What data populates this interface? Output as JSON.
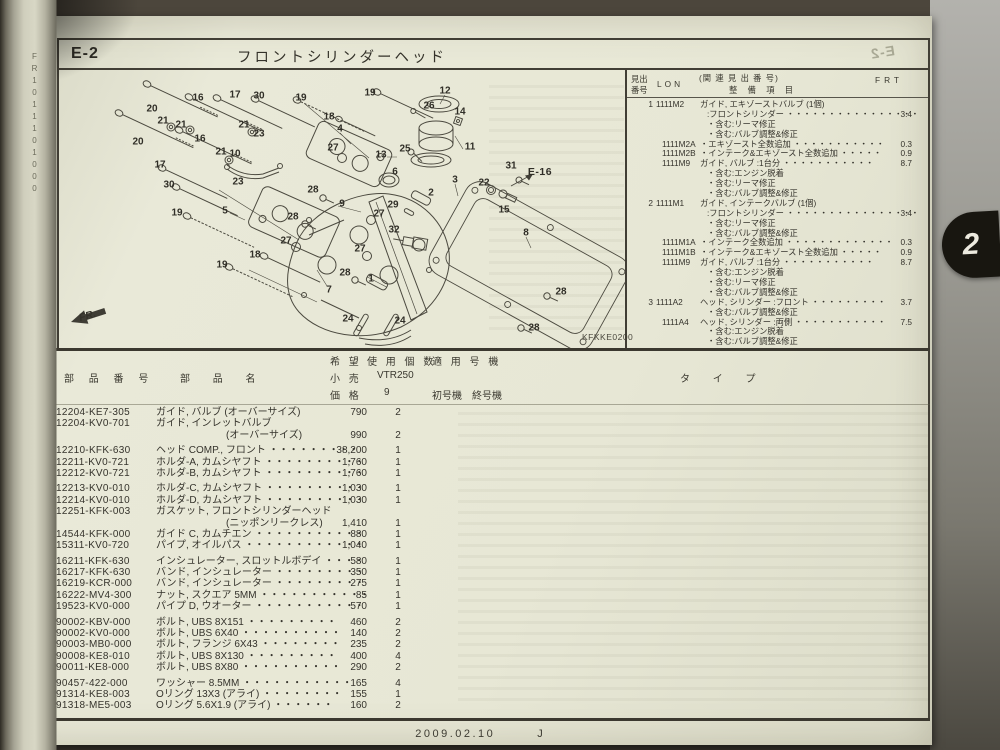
{
  "colors": {
    "page_bg": "#e8e8d7",
    "ink": "#35332c",
    "frame_line": "#413e35",
    "tab_bg": "#181610",
    "tab_text": "#eceadf",
    "desk": "#45403a"
  },
  "spine": {
    "label": "FR",
    "digits": "1011101000"
  },
  "page": {
    "section_code": "E-2",
    "title": "フロントシリンダーヘッド",
    "footer_date": "2009.02.10",
    "footer_mark": "J",
    "tab_number": "2",
    "mirrored_code": "E-2"
  },
  "diagram": {
    "code": "KFKKE0200",
    "fr_label": "FR.",
    "callouts": [
      {
        "t": "20",
        "x": 93,
        "y": 39
      },
      {
        "t": "16",
        "x": 139,
        "y": 28
      },
      {
        "t": "17",
        "x": 176,
        "y": 25
      },
      {
        "t": "30",
        "x": 200,
        "y": 26
      },
      {
        "t": "19",
        "x": 242,
        "y": 28
      },
      {
        "t": "19",
        "x": 311,
        "y": 23
      },
      {
        "t": "18",
        "x": 270,
        "y": 47
      },
      {
        "t": "4",
        "x": 281,
        "y": 59
      },
      {
        "t": "21",
        "x": 104,
        "y": 51
      },
      {
        "t": "21",
        "x": 122,
        "y": 55
      },
      {
        "t": "21",
        "x": 185,
        "y": 55
      },
      {
        "t": "23",
        "x": 200,
        "y": 64
      },
      {
        "t": "20",
        "x": 79,
        "y": 72
      },
      {
        "t": "16",
        "x": 141,
        "y": 69
      },
      {
        "t": "21",
        "x": 162,
        "y": 82
      },
      {
        "t": "10",
        "x": 176,
        "y": 84
      },
      {
        "t": "27",
        "x": 274,
        "y": 78
      },
      {
        "t": "17",
        "x": 101,
        "y": 95
      },
      {
        "t": "23",
        "x": 179,
        "y": 112
      },
      {
        "t": "28",
        "x": 254,
        "y": 120
      },
      {
        "t": "30",
        "x": 110,
        "y": 115
      },
      {
        "t": "19",
        "x": 118,
        "y": 143
      },
      {
        "t": "5",
        "x": 166,
        "y": 141
      },
      {
        "t": "28",
        "x": 234,
        "y": 147
      },
      {
        "t": "9",
        "x": 283,
        "y": 134
      },
      {
        "t": "27",
        "x": 227,
        "y": 171
      },
      {
        "t": "18",
        "x": 196,
        "y": 185
      },
      {
        "t": "19",
        "x": 163,
        "y": 195
      },
      {
        "t": "7",
        "x": 270,
        "y": 220
      },
      {
        "t": "24",
        "x": 289,
        "y": 249
      },
      {
        "t": "24",
        "x": 341,
        "y": 251
      },
      {
        "t": "12",
        "x": 386,
        "y": 21
      },
      {
        "t": "26",
        "x": 370,
        "y": 36
      },
      {
        "t": "14",
        "x": 401,
        "y": 42
      },
      {
        "t": "13",
        "x": 322,
        "y": 85
      },
      {
        "t": "25",
        "x": 346,
        "y": 79
      },
      {
        "t": "11",
        "x": 411,
        "y": 77
      },
      {
        "t": "6",
        "x": 336,
        "y": 102
      },
      {
        "t": "3",
        "x": 396,
        "y": 110
      },
      {
        "t": "22",
        "x": 425,
        "y": 113
      },
      {
        "t": "31",
        "x": 452,
        "y": 96
      },
      {
        "t": "E-16",
        "x": 481,
        "y": 102,
        "b": 1
      },
      {
        "t": "2",
        "x": 372,
        "y": 123
      },
      {
        "t": "29",
        "x": 334,
        "y": 135
      },
      {
        "t": "27",
        "x": 320,
        "y": 144
      },
      {
        "t": "15",
        "x": 445,
        "y": 140
      },
      {
        "t": "32",
        "x": 335,
        "y": 160
      },
      {
        "t": "27",
        "x": 301,
        "y": 179
      },
      {
        "t": "28",
        "x": 286,
        "y": 203
      },
      {
        "t": "1",
        "x": 312,
        "y": 209
      },
      {
        "t": "8",
        "x": 467,
        "y": 163
      },
      {
        "t": "28",
        "x": 502,
        "y": 222
      },
      {
        "t": "28",
        "x": 475,
        "y": 258
      }
    ]
  },
  "service_table": {
    "header": {
      "no1": "見出",
      "no2": "番号",
      "lon": "LON",
      "rel": "(関 連 見 出 番 号)",
      "item": "整 備 項 目",
      "frt": "FRT"
    },
    "rows": [
      {
        "n": "1",
        "l": "1111M2",
        "t": "ガイド, エキゾーストバルブ (1個)"
      },
      {
        "t": ":フロントシリンダー ・・・・・・・・・・・・・・・・",
        "f": "3.4",
        "i": 1
      },
      {
        "t": "・含む:リーマ修正",
        "i": 1
      },
      {
        "t": "・含む:バルブ調整&修正",
        "i": 1
      },
      {
        "l": "1111M2A",
        "t": "・エキゾースト全数追加 ・・・・・・・・・・・",
        "f": "0.3",
        "s": 1
      },
      {
        "l": "1111M2B",
        "t": "・インテーク&エキゾースト全数追加 ・・・・・",
        "f": "0.9",
        "s": 1
      },
      {
        "l": "1111M9",
        "t": "ガイド, バルブ :1台分 ・・・・・・・・・・・",
        "f": "8.7",
        "s": 1
      },
      {
        "t": "・含む:エンジン脱着",
        "i": 1
      },
      {
        "t": "・含む:リーマ修正",
        "i": 1
      },
      {
        "t": "・含む:バルブ調整&修正",
        "i": 1
      },
      {
        "n": "2",
        "l": "1111M1",
        "t": "ガイド, インテークバルブ (1個)"
      },
      {
        "t": ":フロントシリンダー ・・・・・・・・・・・・・・・・",
        "f": "3.4",
        "i": 1
      },
      {
        "t": "・含む:リーマ修正",
        "i": 1
      },
      {
        "t": "・含む:バルブ調整&修正",
        "i": 1
      },
      {
        "l": "1111M1A",
        "t": "・インテーク全数追加 ・・・・・・・・・・・・・",
        "f": "0.3",
        "s": 1
      },
      {
        "l": "1111M1B",
        "t": "・インテーク&エキゾースト全数追加 ・・・・・",
        "f": "0.9",
        "s": 1
      },
      {
        "l": "1111M9",
        "t": "ガイド, バルブ :1台分 ・・・・・・・・・・・",
        "f": "8.7",
        "s": 1
      },
      {
        "t": "・含む:エンジン脱着",
        "i": 1
      },
      {
        "t": "・含む:リーマ修正",
        "i": 1
      },
      {
        "t": "・含む:バルブ調整&修正",
        "i": 1
      },
      {
        "n": "3",
        "l": "1111A2",
        "t": "ヘッド, シリンダー :フロント ・・・・・・・・・",
        "f": "3.7"
      },
      {
        "t": "・含む:バルブ調整&修正",
        "i": 1
      },
      {
        "l": "1111A4",
        "t": "ヘッド, シリンダー :両側 ・・・・・・・・・・・",
        "f": "7.5",
        "s": 1
      },
      {
        "t": "・含む:エンジン脱着",
        "i": 1
      },
      {
        "t": "・含む:バルブ調整&修正",
        "i": 1
      }
    ]
  },
  "parts_table": {
    "header": {
      "no1": "見出",
      "no2": "番号",
      "part": "部 品 番 号",
      "name": "部 品 名",
      "p1": "希 望",
      "p2": "小 売",
      "p3": "価 格",
      "use": "使 用 個 数",
      "model": "適 用 号 機",
      "model_name": "VTR250",
      "model_code": "9",
      "first": "初号機",
      "last": "終号機",
      "type": "タ イ プ"
    },
    "rows": [
      {
        "n": "1",
        "c": "12204-KE7-305",
        "t": "ガイド, バルブ (オーバーサイズ)",
        "p": "790",
        "q": "2"
      },
      {
        "n": "2",
        "c": "12204-KV0-701",
        "t": "ガイド, インレットバルブ",
        "t2": "(オーバーサイズ)",
        "p": "990",
        "q": "2"
      },
      {
        "n": "3",
        "c": "12210-KFK-630",
        "t": "ヘッド COMP., フロント ・・・・・・・・・",
        "p": "38,200",
        "q": "1",
        "g": 1
      },
      {
        "n": "4",
        "c": "12211-KV0-721",
        "t": "ホルダ-A, カムシヤフト ・・・・・・・・・・",
        "p": "1,760",
        "q": "1"
      },
      {
        "n": "5",
        "c": "12212-KV0-721",
        "t": "ホルダ-B, カムシヤフト ・・・・・・・・・・",
        "p": "1,760",
        "q": "1"
      },
      {
        "n": "6",
        "c": "12213-KV0-010",
        "t": "ホルダ-C, カムシヤフト ・・・・・・・・・・",
        "p": "1,030",
        "q": "1",
        "g": 1
      },
      {
        "n": "7",
        "c": "12214-KV0-010",
        "t": "ホルダ-D, カムシヤフト ・・・・・・・・・・",
        "p": "1,030",
        "q": "1"
      },
      {
        "n": "8",
        "c": "12251-KFK-003",
        "t": "ガスケット, フロントシリンダーヘッド",
        "t2": "(ニッポンリークレス)",
        "p": "1,410",
        "q": "1"
      },
      {
        "n": "9",
        "c": "14544-KFK-000",
        "t": "ガイド C, カムチエン ・・・・・・・・・・・",
        "p": "880",
        "q": "1"
      },
      {
        "n": "10",
        "c": "15311-KV0-720",
        "t": "パイプ, オイルパス ・・・・・・・・・・・・",
        "p": "1,040",
        "q": "1"
      },
      {
        "n": "11",
        "c": "16211-KFK-630",
        "t": "インシュレーター, スロットルボデイ ・・・・",
        "p": "580",
        "q": "1",
        "g": 1
      },
      {
        "n": "12",
        "c": "16217-KFK-630",
        "t": "バンド, インシュレーター ・・・・・・・・・",
        "p": "350",
        "q": "1"
      },
      {
        "n": "13",
        "c": "16219-KCR-000",
        "t": "バンド, インシュレーター ・・・・・・・・・",
        "p": "275",
        "q": "1"
      },
      {
        "n": "14",
        "c": "16222-MV4-300",
        "t": "ナット, スクエア 5MM ・・・・・・・・・・・",
        "p": "85",
        "q": "1"
      },
      {
        "n": "15",
        "c": "19523-KV0-000",
        "t": "パイプ D, ウオーター ・・・・・・・・・・・",
        "p": "570",
        "q": "1"
      },
      {
        "n": "16",
        "c": "90002-KBV-000",
        "t": "ボルト, UBS 8X151 ・・・・・・・・・",
        "p": "460",
        "q": "2",
        "g": 1
      },
      {
        "n": "17",
        "c": "90002-KV0-000",
        "t": "ボルト, UBS 6X40 ・・・・・・・・・・",
        "p": "140",
        "q": "2"
      },
      {
        "n": "18",
        "c": "90003-MB0-000",
        "t": "ボルト, フランジ 6X43 ・・・・・・・・",
        "p": "235",
        "q": "2"
      },
      {
        "n": "19",
        "c": "90008-KE8-010",
        "t": "ボルト, UBS 8X130 ・・・・・・・・・",
        "p": "400",
        "q": "4"
      },
      {
        "n": "20",
        "c": "90011-KE8-000",
        "t": "ボルト, UBS 8X80 ・・・・・・・・・・",
        "p": "290",
        "q": "2"
      },
      {
        "n": "21",
        "c": "90457-422-000",
        "t": "ワッシャー 8.5MM ・・・・・・・・・・・",
        "p": "165",
        "q": "4",
        "g": 1
      },
      {
        "n": "22",
        "c": "91314-KE8-003",
        "t": "Oリング 13X3 (アライ) ・・・・・・・・",
        "p": "155",
        "q": "1"
      },
      {
        "n": "23",
        "c": "91318-ME5-003",
        "t": "Oリング 5.6X1.9 (アライ) ・・・・・・",
        "p": "160",
        "q": "2"
      }
    ]
  }
}
